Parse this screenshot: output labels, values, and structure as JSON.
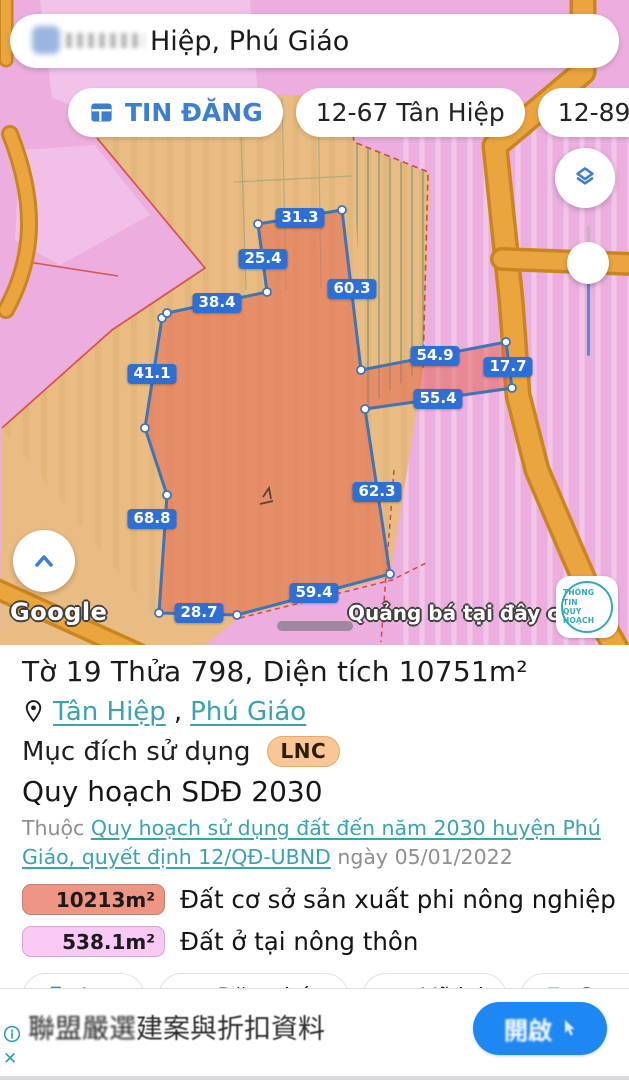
{
  "search": {
    "query": "Hiệp, Phú Giáo"
  },
  "chips": [
    {
      "label": "TIN ĐĂNG"
    },
    {
      "label": "12-67 Tân Hiệp"
    },
    {
      "label": "12-89 Tân Hiệp"
    }
  ],
  "map": {
    "measurements": [
      {
        "value": "31.3",
        "x": 300,
        "y": 218
      },
      {
        "value": "25.4",
        "x": 263,
        "y": 259
      },
      {
        "value": "60.3",
        "x": 352,
        "y": 289
      },
      {
        "value": "38.4",
        "x": 217,
        "y": 303
      },
      {
        "value": "41.1",
        "x": 152,
        "y": 374
      },
      {
        "value": "54.9",
        "x": 435,
        "y": 356
      },
      {
        "value": "17.7",
        "x": 508,
        "y": 367
      },
      {
        "value": "55.4",
        "x": 438,
        "y": 399
      },
      {
        "value": "62.3",
        "x": 377,
        "y": 492
      },
      {
        "value": "68.8",
        "x": 152,
        "y": 519
      },
      {
        "value": "59.4",
        "x": 314,
        "y": 593
      },
      {
        "value": "28.7",
        "x": 199,
        "y": 613
      }
    ],
    "attribution": "Google",
    "ad_overlay": "Quảng bá tại đây chỉ v",
    "stamp": {
      "line1": "THÔNG TIN",
      "line2": "QUY HOẠCH"
    }
  },
  "parcel": {
    "title": "Tờ 19 Thửa 798, Diện tích 10751m²",
    "location": {
      "commune": "Tân Hiệp",
      "separator": ", ",
      "district": "Phú Giáo"
    },
    "purpose_label": "Mục đích sử dụng",
    "purpose_code": "LNC",
    "plan_title": "Quy hoạch SDĐ 2030",
    "plan_prefix": "Thuộc ",
    "plan_link": "Quy hoạch sử dụng đất đến năm 2030 huyện Phú Giáo, quyết định 12/QĐ-UBND",
    "plan_suffix": " ngày 05/01/2022",
    "legend": [
      {
        "area": "10213m²",
        "label": "Đất cơ sở sản xuất phi nông nghiệp",
        "color": "#ee9683",
        "border": "#bf8277"
      },
      {
        "area": "538.1m²",
        "label": "Đất ở tại nông thôn",
        "color": "#f9c9f6",
        "border": "#d8a3d3"
      }
    ]
  },
  "actions": [
    {
      "label": "Lưu"
    },
    {
      "label": "Đăng bán"
    },
    {
      "label": "Vẽ lại"
    },
    {
      "label": "Sao"
    }
  ],
  "ad": {
    "headline_obscured": "聯盟嚴選",
    "headline": "建案與折扣資料",
    "button_label": "開啟"
  },
  "colors": {
    "accent_blue": "#3d7dd2",
    "link_teal": "#3aa3ae",
    "measure_chip_blue": "#2e6fd6",
    "parcel_fill": "#e8907c",
    "road_orange": "#eaa53f",
    "zone_pink": "#ecaede",
    "zone_tan": "#e8bc82",
    "ad_button_blue": "#1e88f2"
  }
}
